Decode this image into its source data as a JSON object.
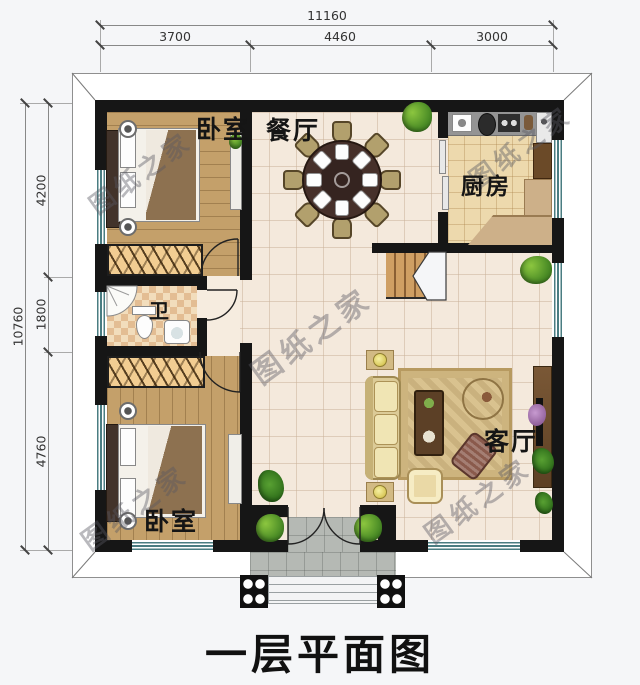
{
  "title": "一层平面图",
  "watermark": {
    "text": "图纸之家"
  },
  "rooms": {
    "bedroom_top": "卧室",
    "dining": "餐厅",
    "kitchen": "厨房",
    "bath": "卫",
    "living": "客厅",
    "bedroom_bottom": "卧室"
  },
  "dimensions": {
    "top": {
      "total": "11160",
      "segments": [
        "3700",
        "4460",
        "3000"
      ]
    },
    "left": {
      "total": "10760",
      "segments": [
        "4200",
        "1800",
        "4760"
      ]
    }
  },
  "colors": {
    "wall": "#161616",
    "wood_floor": "#c4a06a",
    "tile_floor": "#f4e9dc",
    "kitchen_floor": "#edd9ad",
    "window_mullion": "#4a7d82",
    "porch": "#b5b9b4"
  }
}
